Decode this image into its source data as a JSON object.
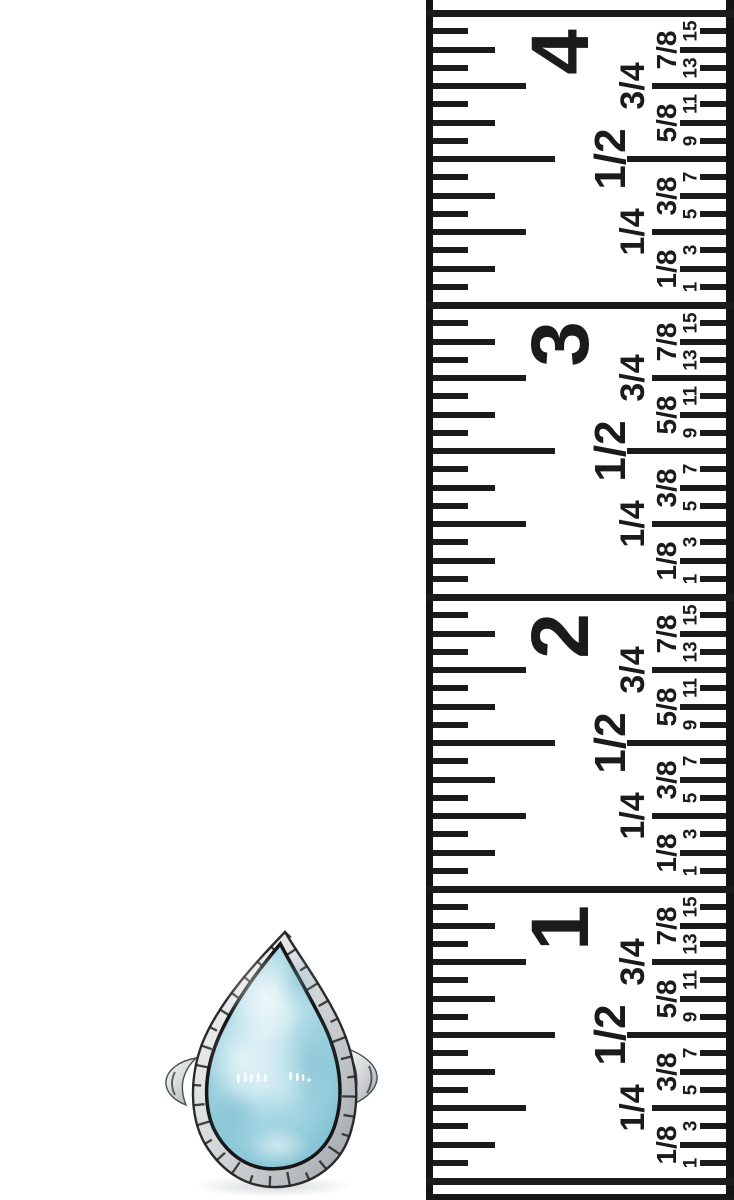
{
  "scene": {
    "type": "product-photo",
    "subject": "silver ring with light-blue teardrop stone beside vertical inch ruler"
  },
  "ruler": {
    "inch_numerals": [
      "4",
      "3",
      "2",
      "1"
    ],
    "fraction_labels": [
      "1/8",
      "1/4",
      "3/8",
      "1/2",
      "5/8",
      "3/4",
      "7/8"
    ],
    "sixteenth_numerals": [
      "1",
      "3",
      "5",
      "7",
      "9",
      "11",
      "13",
      "15"
    ],
    "colors": {
      "ink": "#1b1b1b",
      "tape": "#ffffff"
    }
  },
  "ring": {
    "stone_name": "larimar-teardrop-cabochon",
    "colors": {
      "stone_light": "#d6edf2",
      "stone_mid": "#a9d8e4",
      "stone_deep": "#76bace",
      "metal_light": "#f5f6f6",
      "metal_mid": "#c3c8ca",
      "metal_dark": "#989ea2",
      "outline": "#1c1c1c"
    }
  }
}
